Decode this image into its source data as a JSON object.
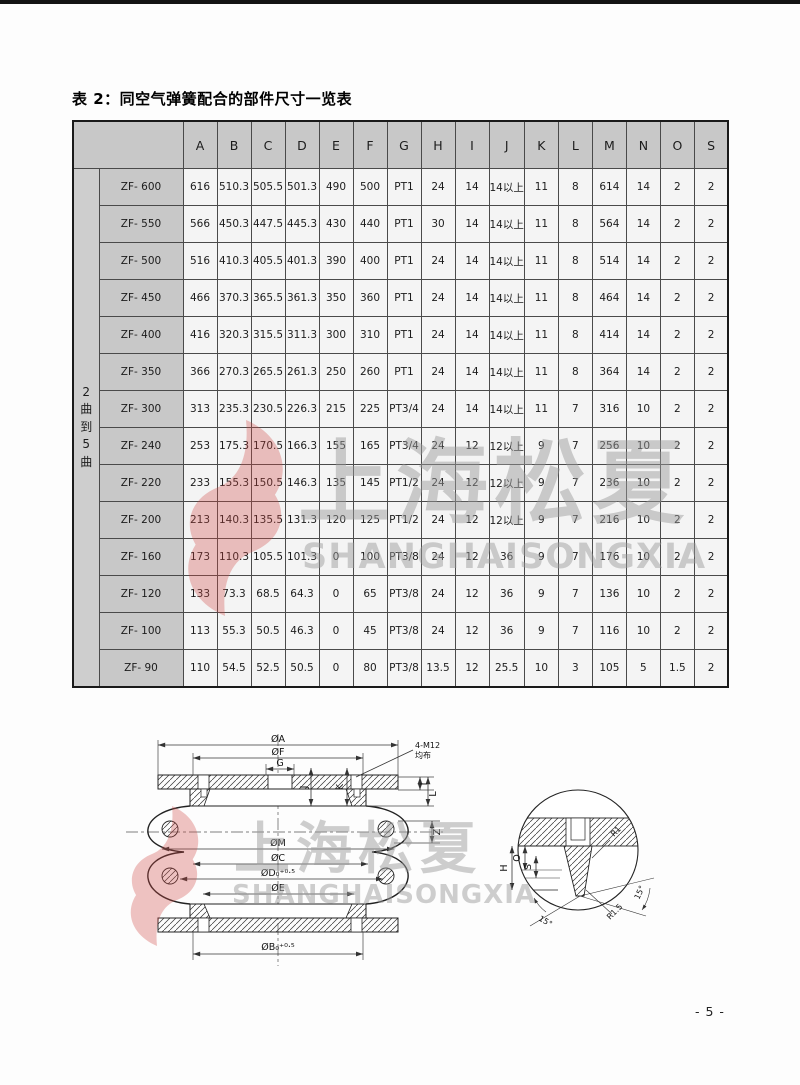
{
  "page": {
    "title": "表 2：同空气弹簧配合的部件尺寸一览表",
    "page_number": "- 5 -"
  },
  "watermark": {
    "cn": "上海松夏",
    "en": "SHANGHAISONGXIA",
    "red_color": "#cf4a45",
    "gray_color": "#9b9b9b"
  },
  "colors": {
    "header_bg": "#c8c8c8",
    "cell_bg": "#f4f4f4",
    "border": "#4a4a4a"
  },
  "table": {
    "row_group_label": "2曲到5曲",
    "columns": [
      "A",
      "B",
      "C",
      "D",
      "E",
      "F",
      "G",
      "H",
      "I",
      "J",
      "K",
      "L",
      "M",
      "N",
      "O",
      "S"
    ],
    "rows": [
      {
        "model": "ZF- 600",
        "values": [
          "616",
          "510.3",
          "505.5",
          "501.3",
          "490",
          "500",
          "PT1",
          "24",
          "14",
          "14以上",
          "11",
          "8",
          "614",
          "14",
          "2",
          "2"
        ]
      },
      {
        "model": "ZF- 550",
        "values": [
          "566",
          "450.3",
          "447.5",
          "445.3",
          "430",
          "440",
          "PT1",
          "30",
          "14",
          "14以上",
          "11",
          "8",
          "564",
          "14",
          "2",
          "2"
        ]
      },
      {
        "model": "ZF- 500",
        "values": [
          "516",
          "410.3",
          "405.5",
          "401.3",
          "390",
          "400",
          "PT1",
          "24",
          "14",
          "14以上",
          "11",
          "8",
          "514",
          "14",
          "2",
          "2"
        ]
      },
      {
        "model": "ZF- 450",
        "values": [
          "466",
          "370.3",
          "365.5",
          "361.3",
          "350",
          "360",
          "PT1",
          "24",
          "14",
          "14以上",
          "11",
          "8",
          "464",
          "14",
          "2",
          "2"
        ]
      },
      {
        "model": "ZF- 400",
        "values": [
          "416",
          "320.3",
          "315.5",
          "311.3",
          "300",
          "310",
          "PT1",
          "24",
          "14",
          "14以上",
          "11",
          "8",
          "414",
          "14",
          "2",
          "2"
        ]
      },
      {
        "model": "ZF- 350",
        "values": [
          "366",
          "270.3",
          "265.5",
          "261.3",
          "250",
          "260",
          "PT1",
          "24",
          "14",
          "14以上",
          "11",
          "8",
          "364",
          "14",
          "2",
          "2"
        ]
      },
      {
        "model": "ZF- 300",
        "values": [
          "313",
          "235.3",
          "230.5",
          "226.3",
          "215",
          "225",
          "PT3/4",
          "24",
          "14",
          "14以上",
          "11",
          "7",
          "316",
          "10",
          "2",
          "2"
        ]
      },
      {
        "model": "ZF- 240",
        "values": [
          "253",
          "175.3",
          "170.5",
          "166.3",
          "155",
          "165",
          "PT3/4",
          "24",
          "12",
          "12以上",
          "9",
          "7",
          "256",
          "10",
          "2",
          "2"
        ]
      },
      {
        "model": "ZF- 220",
        "values": [
          "233",
          "155.3",
          "150.5",
          "146.3",
          "135",
          "145",
          "PT1/2",
          "24",
          "12",
          "12以上",
          "9",
          "7",
          "236",
          "10",
          "2",
          "2"
        ]
      },
      {
        "model": "ZF- 200",
        "values": [
          "213",
          "140.3",
          "135.5",
          "131.3",
          "120",
          "125",
          "PT1/2",
          "24",
          "12",
          "12以上",
          "9",
          "7",
          "216",
          "10",
          "2",
          "2"
        ]
      },
      {
        "model": "ZF- 160",
        "values": [
          "173",
          "110.3",
          "105.5",
          "101.3",
          "0",
          "100",
          "PT3/8",
          "24",
          "12",
          "36",
          "9",
          "7",
          "176",
          "10",
          "2",
          "2"
        ]
      },
      {
        "model": "ZF- 120",
        "values": [
          "133",
          "73.3",
          "68.5",
          "64.3",
          "0",
          "65",
          "PT3/8",
          "24",
          "12",
          "36",
          "9",
          "7",
          "136",
          "10",
          "2",
          "2"
        ]
      },
      {
        "model": "ZF- 100",
        "values": [
          "113",
          "55.3",
          "50.5",
          "46.3",
          "0",
          "45",
          "PT3/8",
          "24",
          "12",
          "36",
          "9",
          "7",
          "116",
          "10",
          "2",
          "2"
        ]
      },
      {
        "model": "ZF- 90",
        "values": [
          "110",
          "54.5",
          "52.5",
          "50.5",
          "0",
          "80",
          "PT3/8",
          "13.5",
          "12",
          "25.5",
          "10",
          "3",
          "105",
          "5",
          "1.5",
          "2"
        ]
      }
    ]
  },
  "diagram": {
    "labels": {
      "oa": "ØA",
      "of": "ØF",
      "g": "G",
      "m12": "4-M12",
      "m12b": "均布",
      "j": "J",
      "k": "K",
      "i": "I",
      "l": "L",
      "z": "Z",
      "om": "ØM",
      "oc": "ØC",
      "od": "ØD₀⁺⁰·⁵",
      "oe": "ØE",
      "ob": "ØB₀⁺⁰·⁵",
      "h": "H",
      "o": "O",
      "s": "S",
      "r1": "R1",
      "r15": "R1.5",
      "a1": "15°",
      "a2": "15°"
    }
  }
}
